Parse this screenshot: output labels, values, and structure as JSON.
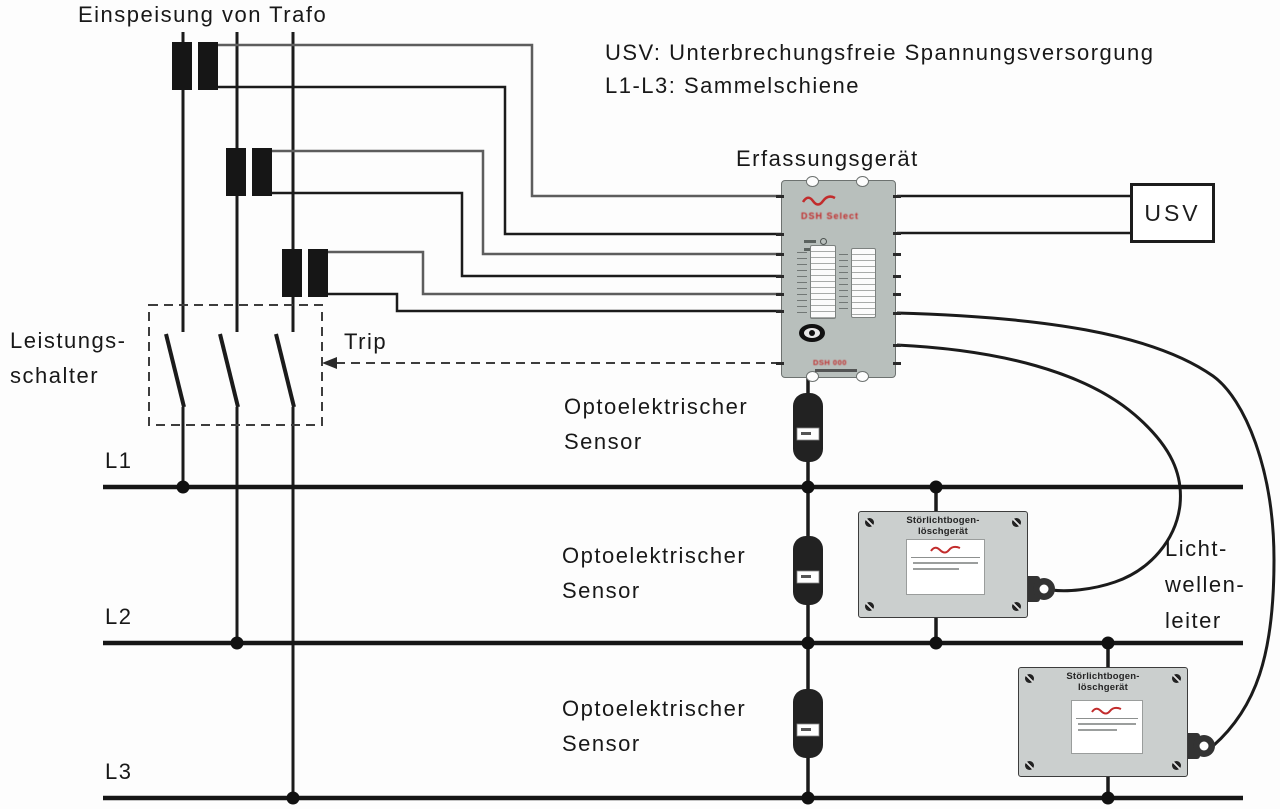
{
  "colors": {
    "wire_gray": "#5d5d5d",
    "wire_black": "#1b1b1b",
    "busbar_black": "#161616",
    "device_body": "#b8bfbc",
    "quench_body": "#cbcfce",
    "accent_red": "#c22c2c"
  },
  "header": {
    "title": "Einspeisung von Trafo"
  },
  "legend": {
    "line1": "USV: Unterbrechungsfreie Spannungsversorgung",
    "line2": "L1-L3: Sammelschiene"
  },
  "detector": {
    "label": "Erfassungsgerät",
    "model_text": "DSH Select",
    "bottom_text": "DSH 000"
  },
  "ups": {
    "label": "USV"
  },
  "breaker": {
    "label_line1": "Leistungs-",
    "label_line2": "schalter",
    "trip": "Trip"
  },
  "busbars": [
    {
      "label": "L1"
    },
    {
      "label": "L2"
    },
    {
      "label": "L3"
    }
  ],
  "sensors": [
    {
      "label_line1": "Optoelektrischer",
      "label_line2": "Sensor"
    },
    {
      "label_line1": "Optoelektrischer",
      "label_line2": "Sensor"
    },
    {
      "label_line1": "Optoelektrischer",
      "label_line2": "Sensor"
    }
  ],
  "quench_devices": [
    {
      "title_line1": "Störlichtbogen-",
      "title_line2": "löschgerät"
    },
    {
      "title_line1": "Störlichtbogen-",
      "title_line2": "löschgerät"
    }
  ],
  "fiber": {
    "line1": "Licht-",
    "line2": "wellen-",
    "line3": "leiter"
  }
}
